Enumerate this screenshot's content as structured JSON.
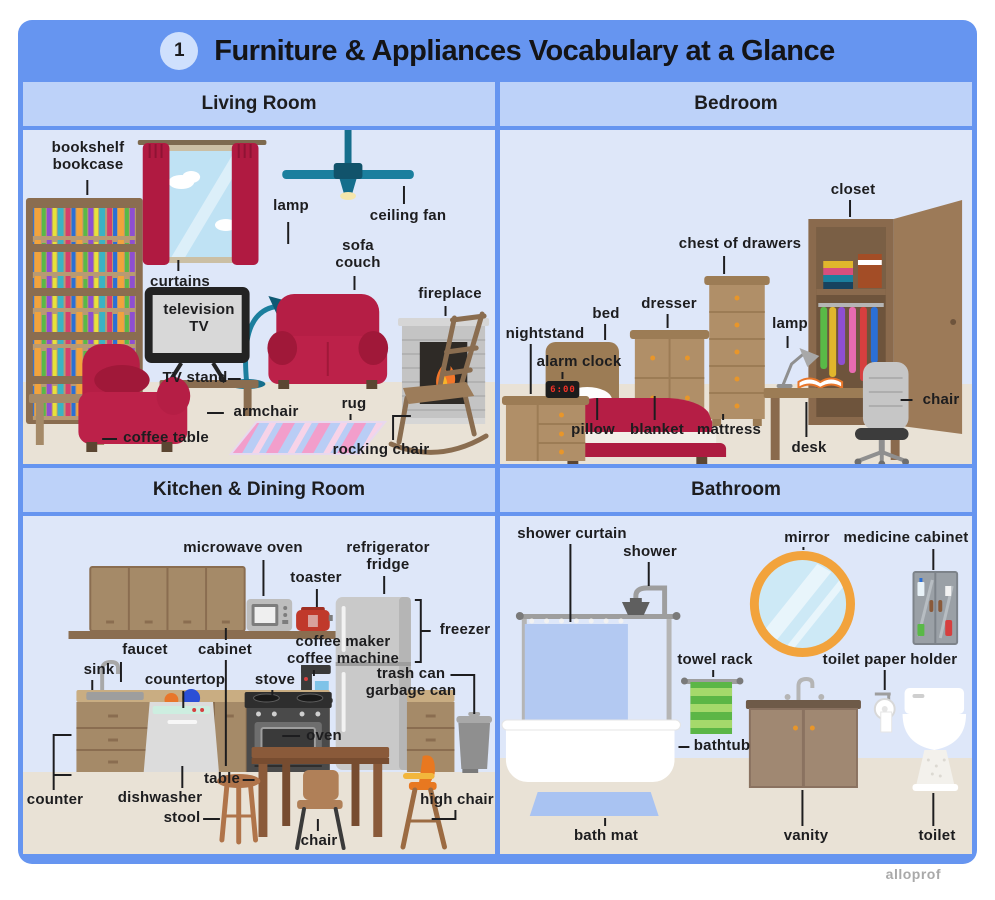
{
  "header": {
    "badge": "1",
    "title": "Furniture & Appliances Vocabulary at a Glance"
  },
  "watermark": "alloprof",
  "colors": {
    "frame_blue": "#6695f0",
    "section_blue": "#bdd2f9",
    "panel_blue": "#dee7f9",
    "floor_beige": "#e9e2d6",
    "accent_red": "#b51e45",
    "wood_brown": "#a58a68",
    "teal": "#1b7f9e",
    "alarm_red": "#f03226"
  },
  "sections": [
    {
      "id": "living",
      "title": "Living Room",
      "labels": [
        {
          "id": "bookshelf-bookcase",
          "text": "bookshelf\nbookcase"
        },
        {
          "id": "curtains",
          "text": "curtains"
        },
        {
          "id": "lamp",
          "text": "lamp"
        },
        {
          "id": "ceiling-fan",
          "text": "ceiling fan"
        },
        {
          "id": "sofa-couch",
          "text": "sofa\ncouch"
        },
        {
          "id": "fireplace",
          "text": "fireplace"
        },
        {
          "id": "television-tv",
          "text": "television\nTV"
        },
        {
          "id": "tv-stand",
          "text": "TV stand"
        },
        {
          "id": "armchair",
          "text": "armchair"
        },
        {
          "id": "coffee-table",
          "text": "coffee table"
        },
        {
          "id": "rug",
          "text": "rug"
        },
        {
          "id": "rocking-chair",
          "text": "rocking chair"
        }
      ]
    },
    {
      "id": "bedroom",
      "title": "Bedroom",
      "alarm_time": "6:00",
      "labels": [
        {
          "id": "closet",
          "text": "closet"
        },
        {
          "id": "chest-of-drawers",
          "text": "chest of drawers"
        },
        {
          "id": "dresser",
          "text": "dresser"
        },
        {
          "id": "bed",
          "text": "bed"
        },
        {
          "id": "nightstand",
          "text": "nightstand"
        },
        {
          "id": "alarm-clock",
          "text": "alarm clock"
        },
        {
          "id": "lamp",
          "text": "lamp"
        },
        {
          "id": "chair",
          "text": "chair"
        },
        {
          "id": "desk",
          "text": "desk"
        },
        {
          "id": "pillow",
          "text": "pillow"
        },
        {
          "id": "blanket",
          "text": "blanket"
        },
        {
          "id": "mattress",
          "text": "mattress"
        }
      ]
    },
    {
      "id": "kitchen",
      "title": "Kitchen & Dining Room",
      "labels": [
        {
          "id": "microwave-oven",
          "text": "microwave oven"
        },
        {
          "id": "toaster",
          "text": "toaster"
        },
        {
          "id": "refrigerator-fridge",
          "text": "refrigerator\nfridge"
        },
        {
          "id": "freezer",
          "text": "freezer"
        },
        {
          "id": "coffee-maker",
          "text": "coffee maker\ncoffee machine"
        },
        {
          "id": "faucet",
          "text": "faucet"
        },
        {
          "id": "sink",
          "text": "sink"
        },
        {
          "id": "cabinet",
          "text": "cabinet"
        },
        {
          "id": "countertop",
          "text": "countertop"
        },
        {
          "id": "stove",
          "text": "stove"
        },
        {
          "id": "trash-can",
          "text": "trash can\ngarbage can"
        },
        {
          "id": "oven",
          "text": "oven"
        },
        {
          "id": "counter",
          "text": "counter"
        },
        {
          "id": "dishwasher",
          "text": "dishwasher"
        },
        {
          "id": "table",
          "text": "table"
        },
        {
          "id": "stool",
          "text": "stool"
        },
        {
          "id": "chair",
          "text": "chair"
        },
        {
          "id": "high-chair",
          "text": "high chair"
        }
      ]
    },
    {
      "id": "bathroom",
      "title": "Bathroom",
      "labels": [
        {
          "id": "shower-curtain",
          "text": "shower curtain"
        },
        {
          "id": "shower",
          "text": "shower"
        },
        {
          "id": "mirror",
          "text": "mirror"
        },
        {
          "id": "medicine-cabinet",
          "text": "medicine cabinet"
        },
        {
          "id": "towel-rack",
          "text": "towel rack"
        },
        {
          "id": "toilet-paper-holder",
          "text": "toilet paper holder"
        },
        {
          "id": "bathtub",
          "text": "bathtub"
        },
        {
          "id": "bath-mat",
          "text": "bath mat"
        },
        {
          "id": "vanity",
          "text": "vanity"
        },
        {
          "id": "toilet",
          "text": "toilet"
        }
      ]
    }
  ]
}
